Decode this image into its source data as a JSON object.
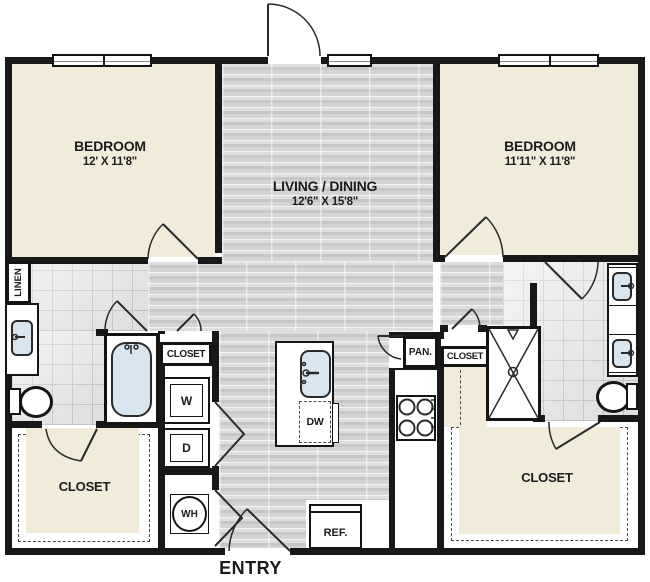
{
  "plan": {
    "title_hidden": "",
    "entry_label": "ENTRY",
    "rooms": {
      "bedroom_left": {
        "name": "BEDROOM",
        "dims": "12' X 11'8\""
      },
      "bedroom_right": {
        "name": "BEDROOM",
        "dims": "11'11\" X 11'8\""
      },
      "living_dining": {
        "name": "LIVING / DINING",
        "dims": "12'6\" X 15'8\""
      },
      "closet_left_walkin": {
        "name": "CLOSET"
      },
      "closet_right_walkin": {
        "name": "CLOSET"
      },
      "closet_left_small": {
        "name": "CLOSET"
      },
      "closet_right_small": {
        "name": "CLOSET"
      },
      "linen": {
        "name": "LINEN"
      },
      "pantry": {
        "name": "PAN."
      }
    },
    "appliances": {
      "washer": "W",
      "dryer": "D",
      "water_heater": "WH",
      "dishwasher": "DW",
      "refrigerator": "REF."
    },
    "colors": {
      "wall": "#181818",
      "room_fill": "#f1ebda",
      "wood_floor": "#d0d0d0",
      "tile_floor": "#e9e9e9",
      "fixture_blue": "#d9e6ef"
    }
  }
}
